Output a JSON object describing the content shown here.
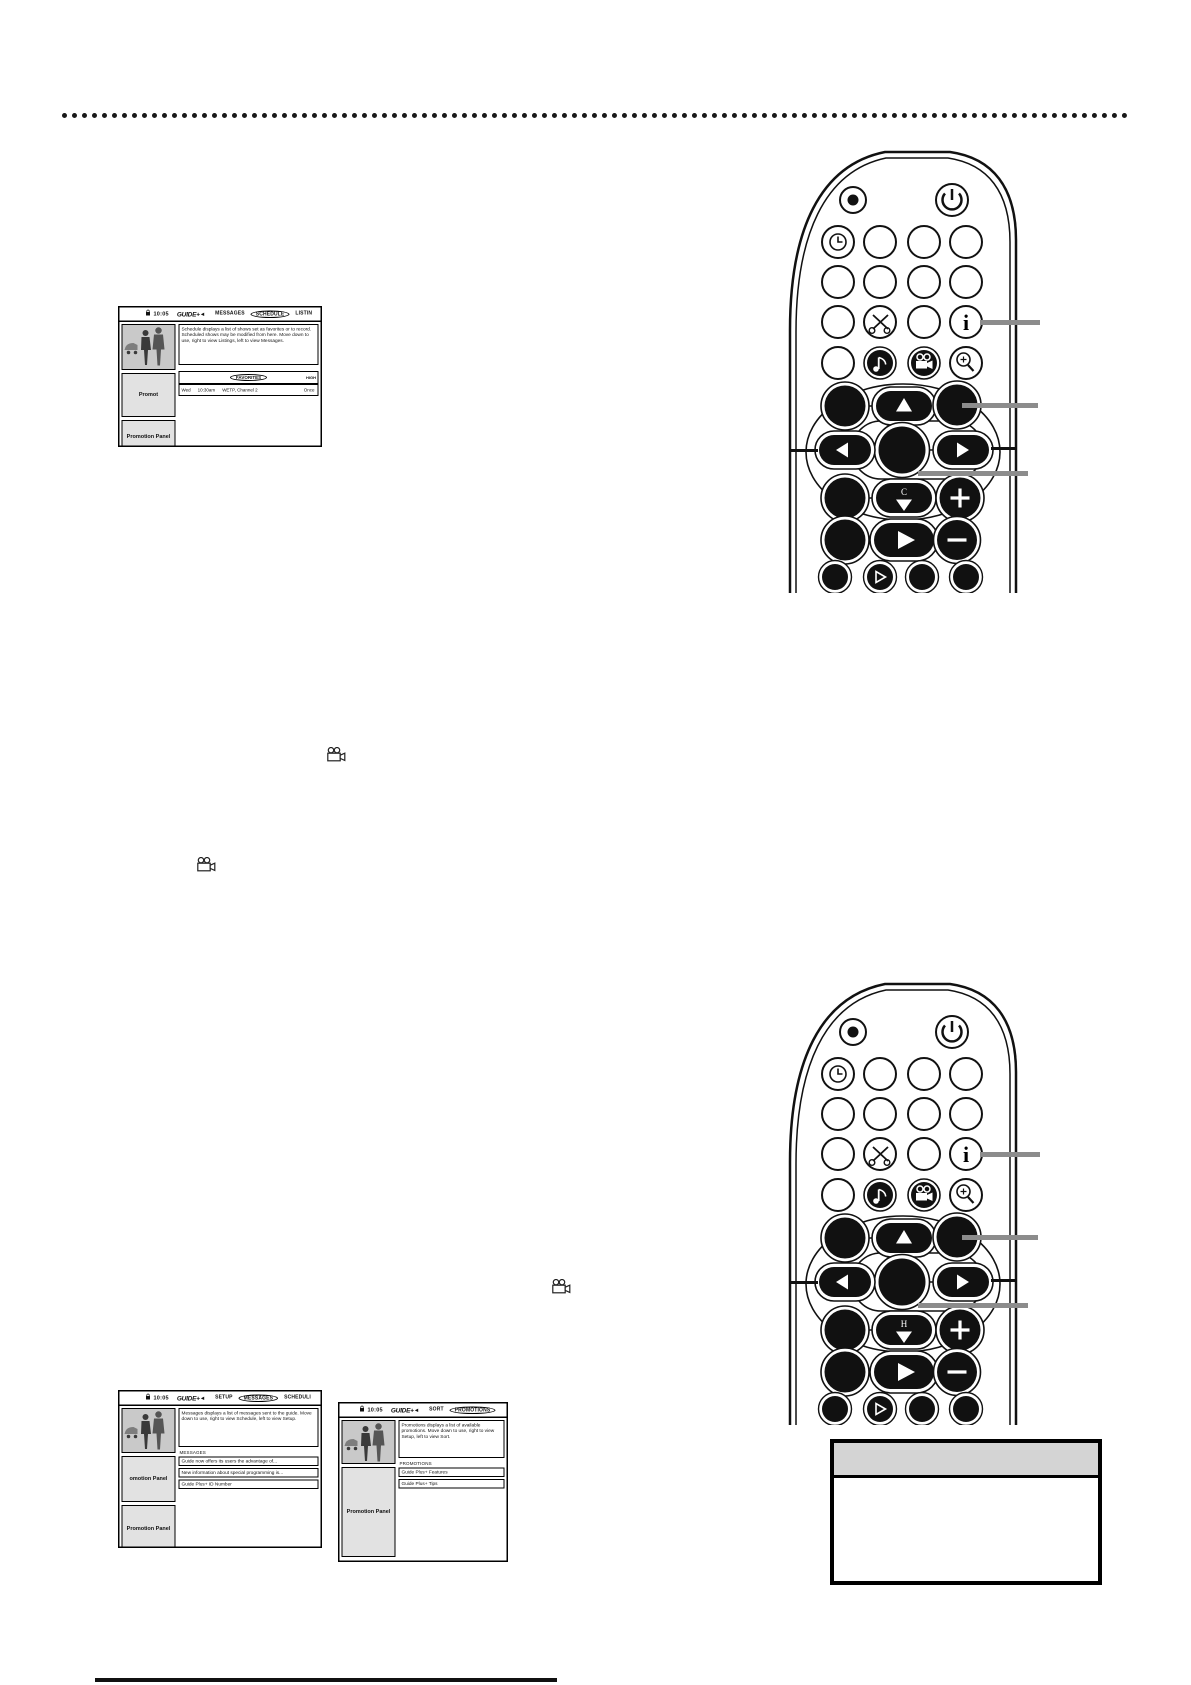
{
  "page": {
    "background": "#ffffff",
    "kind": "scanned-manual-page"
  },
  "screens": [
    {
      "name": "schedule-screen",
      "lock_icon": "lock-icon",
      "time": "10:05",
      "logo": "GUIDE+",
      "logo_arrow": "◀",
      "tabs": [
        "MESSAGES",
        "SCHEDULE",
        "LISTIN"
      ],
      "active_tab": "SCHEDULE",
      "description": "Schedule displays a list of shows set as favorites or to record. Scheduled shows may be modified from here. Move down to use, right to view Listings, left to view Messages.",
      "section_label": "FAVORITES",
      "section_right_label": "HIGH",
      "favorite_row": {
        "day": "Wed",
        "time": "10:30am",
        "channel": "WETP, Channel 2",
        "frequency": "Once"
      },
      "panels": [
        "Promot",
        "Promotion Panel"
      ]
    },
    {
      "name": "messages-screen",
      "lock_icon": "lock-icon",
      "time": "10:05",
      "logo": "GUIDE+",
      "logo_arrow": "◀",
      "tabs": [
        "SETUP",
        "MESSAGES",
        "SCHEDULI"
      ],
      "active_tab": "MESSAGES",
      "description": "Messages displays a list of messages sent to the guide. Move down to use, right to view Schedule, left to view Setup.",
      "section_label": "MESSAGES",
      "rows": [
        "Guide now offers its users the advantage of...",
        "New information about special programming is...",
        "Guide Plus+ ID Number"
      ],
      "panels": [
        "omotion Panel",
        "Promotion Panel"
      ]
    },
    {
      "name": "promotions-screen",
      "lock_icon": "lock-icon",
      "time": "10:05",
      "logo": "GUIDE+",
      "logo_arrow": "◀",
      "tabs": [
        "SORT",
        "PROMOTIONS"
      ],
      "active_tab": "PROMOTIONS",
      "description": "Promotions displays a list of available promotions. Move down to use, right to view Setup, left to view Sort.",
      "section_label": "PROMOTIONS",
      "rows": [
        "Guide Plus+ Features",
        "Guide Plus+ Tips"
      ],
      "panels": [
        "Promotion Panel"
      ]
    }
  ],
  "remotes": [
    {
      "name": "remote-top",
      "down_button_label": "C"
    },
    {
      "name": "remote-bottom",
      "down_button_label": "H"
    }
  ],
  "remote_button_icons": [
    "record-icon",
    "power-icon",
    "clock-icon",
    "scissors-icon",
    "info-icon",
    "sound-icon",
    "camcorder-icon",
    "zoom-in-icon",
    "arrow-up-icon",
    "arrow-down-icon",
    "arrow-left-icon",
    "arrow-right-icon",
    "ok-icon",
    "plus-icon",
    "minus-icon",
    "play-icon"
  ],
  "inline_icons": [
    {
      "name": "camcorder-icon"
    },
    {
      "name": "camcorder-icon"
    },
    {
      "name": "camcorder-icon"
    }
  ],
  "note_box": {
    "header": ""
  }
}
